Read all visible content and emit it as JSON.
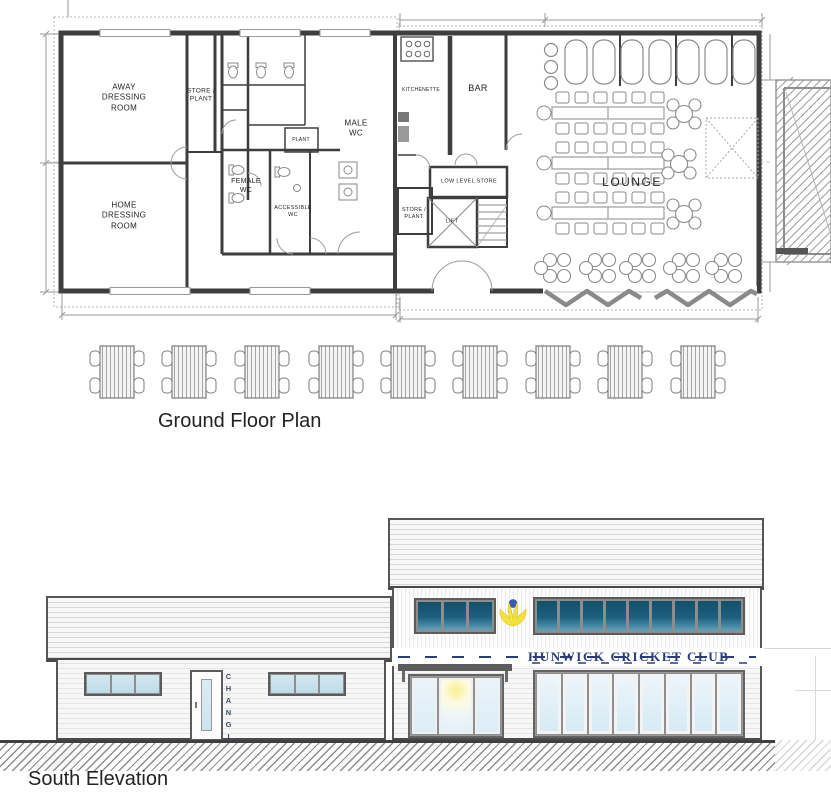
{
  "plan": {
    "caption": "Ground Floor Plan",
    "rooms": {
      "away": "AWAY\nDRESSING\nROOM",
      "store1": "STORE /\nPLANT",
      "home": "HOME\nDRESSING\nROOM",
      "male_wc": "MALE\nWC",
      "female_wc": "FEMALE\nWC",
      "accessible_wc": "ACCESSIBLE\nWC",
      "plant": "PLANT",
      "kitchenette": "KITCHENETTE",
      "bar": "BAR",
      "low_level_store": "LOW LEVEL STORE",
      "store2": "STORE /\nPLANT",
      "lift": "LIFT",
      "lounge": "LOUNGE"
    }
  },
  "elevation": {
    "caption": "South Elevation",
    "sign": "HUNWICK CRICKET CLUB",
    "changing": "CHANGING"
  },
  "colors": {
    "linework": "#3e3e3e",
    "sign_navy": "#2a3c7c",
    "glass_dark": "#1b5a76",
    "glass_light": "#dcedf5",
    "logo_yellow": "#f3e13c",
    "logo_blue": "#3d5cab",
    "ground_hatch": "#8d8d8d"
  }
}
